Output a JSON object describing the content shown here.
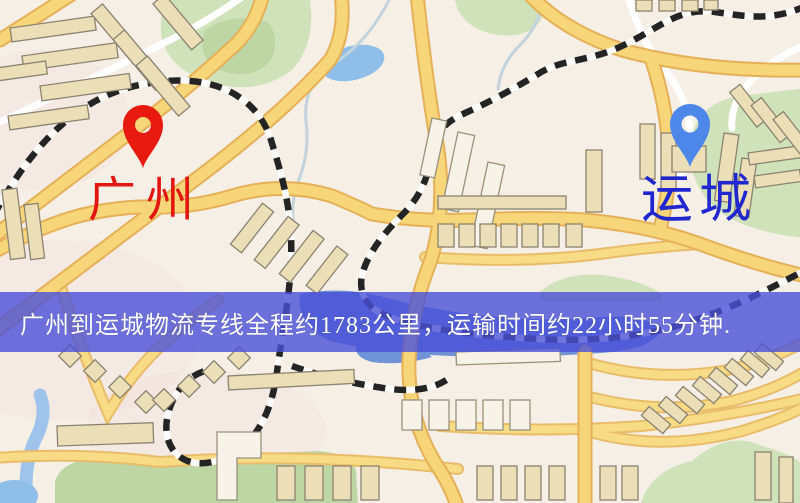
{
  "map": {
    "origin": {
      "label": "广州",
      "pin_icon": "red-location-pin",
      "pin_color": "#e8190e",
      "label_color": "#e21510"
    },
    "destination": {
      "label": "运城",
      "pin_icon": "blue-location-pin",
      "pin_color": "#4d87ea",
      "label_color": "#2127cf"
    },
    "banner": {
      "text": "广州到运城物流专线全程约1783公里，运输时间约22小时55分钟.",
      "background_color": "#4a50d8",
      "text_color": "#ffffff",
      "distance_text": "约1783公里",
      "duration_text": "约22小时55分钟"
    },
    "colors": {
      "map_background": "#f6efe6",
      "road_fill": "#f6d678",
      "road_casing": "#e5b058",
      "railway_dash": "#242424",
      "building_fill": "#ecdfb8",
      "park_green": "#cfe2ba",
      "pond_blue": "#8fbfe8",
      "lake_blue": "#6f93d6"
    }
  }
}
